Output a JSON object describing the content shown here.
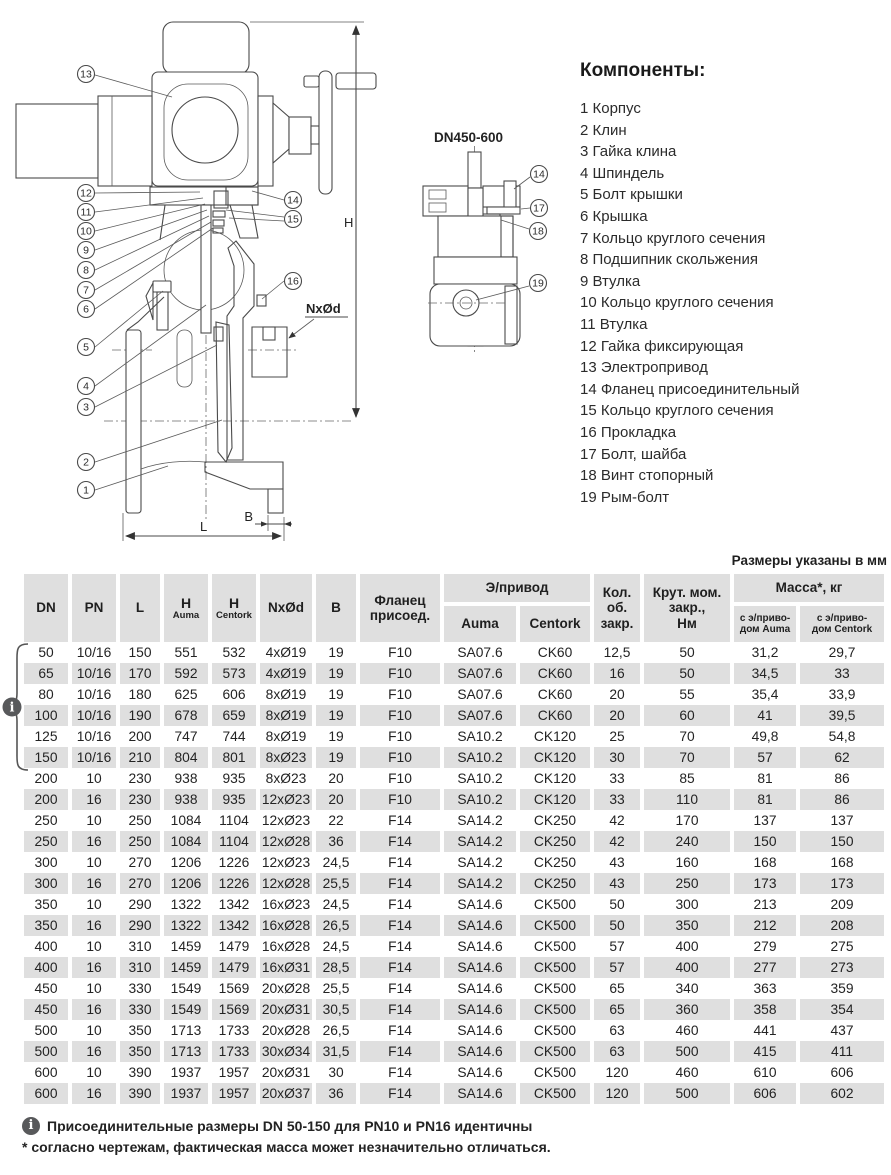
{
  "colors": {
    "table_cell_bg": "#dfdfdf",
    "icon_bg": "#58595b",
    "line": "#4a4a4a"
  },
  "icons": {
    "info": "i"
  },
  "components": {
    "title": "Компоненты:",
    "items": [
      "1 Корпус",
      "2 Клин",
      "3 Гайка клина",
      "4 Шпиндель",
      "5 Болт крышки",
      "6 Крышка",
      "7 Кольцо круглого сечения",
      "8 Подшипник скольжения",
      "9 Втулка",
      "10 Кольцо круглого сечения",
      "11 Втулка",
      "12 Гайка фиксирующая",
      "13 Электропривод",
      "14 Фланец присоединительный",
      "15 Кольцо круглого сечения",
      "16 Прокладка",
      "17 Болт, шайба",
      "18 Винт стопорный",
      "19 Рым-болт"
    ]
  },
  "diagrams": {
    "main": {
      "callouts": [
        "1",
        "2",
        "3",
        "4",
        "5",
        "6",
        "7",
        "8",
        "9",
        "10",
        "11",
        "12",
        "13",
        "14",
        "15",
        "16"
      ],
      "dims": {
        "h": "H",
        "l": "L",
        "b": "B",
        "holes": "NxØd"
      }
    },
    "detail": {
      "title": "DN450-600",
      "callouts": [
        "14",
        "17",
        "18",
        "19"
      ]
    }
  },
  "table": {
    "units_note": "Размеры указаны в мм",
    "header": {
      "dn": "DN",
      "pn": "PN",
      "l": "L",
      "h_label": "H",
      "h_sub_auma": "Auma",
      "h_sub_centork": "Centork",
      "nxod": "NxØd",
      "b": "B",
      "flange": "Фланец\nприсоед.",
      "actuator_group": "Э/привод",
      "auma": "Auma",
      "centork": "Centork",
      "turns": "Кол.\nоб.\nзакр.",
      "torque": "Крут. мом.\nзакр.,\nНм",
      "mass_group": "Масса*, кг",
      "mass_auma": "с э/приво-\nдом Auma",
      "mass_centork": "с э/приво-\nдом Centork"
    },
    "rows": [
      [
        "50",
        "10/16",
        "150",
        "551",
        "532",
        "4xØ19",
        "19",
        "F10",
        "SA07.6",
        "CK60",
        "12,5",
        "50",
        "31,2",
        "29,7"
      ],
      [
        "65",
        "10/16",
        "170",
        "592",
        "573",
        "4xØ19",
        "19",
        "F10",
        "SA07.6",
        "CK60",
        "16",
        "50",
        "34,5",
        "33"
      ],
      [
        "80",
        "10/16",
        "180",
        "625",
        "606",
        "8xØ19",
        "19",
        "F10",
        "SA07.6",
        "CK60",
        "20",
        "55",
        "35,4",
        "33,9"
      ],
      [
        "100",
        "10/16",
        "190",
        "678",
        "659",
        "8xØ19",
        "19",
        "F10",
        "SA07.6",
        "CK60",
        "20",
        "60",
        "41",
        "39,5"
      ],
      [
        "125",
        "10/16",
        "200",
        "747",
        "744",
        "8xØ19",
        "19",
        "F10",
        "SA10.2",
        "CK120",
        "25",
        "70",
        "49,8",
        "54,8"
      ],
      [
        "150",
        "10/16",
        "210",
        "804",
        "801",
        "8xØ23",
        "19",
        "F10",
        "SA10.2",
        "CK120",
        "30",
        "70",
        "57",
        "62"
      ],
      [
        "200",
        "10",
        "230",
        "938",
        "935",
        "8xØ23",
        "20",
        "F10",
        "SA10.2",
        "CK120",
        "33",
        "85",
        "81",
        "86"
      ],
      [
        "200",
        "16",
        "230",
        "938",
        "935",
        "12xØ23",
        "20",
        "F10",
        "SA10.2",
        "CK120",
        "33",
        "110",
        "81",
        "86"
      ],
      [
        "250",
        "10",
        "250",
        "1084",
        "1104",
        "12xØ23",
        "22",
        "F14",
        "SA14.2",
        "CK250",
        "42",
        "170",
        "137",
        "137"
      ],
      [
        "250",
        "16",
        "250",
        "1084",
        "1104",
        "12xØ28",
        "36",
        "F14",
        "SA14.2",
        "CK250",
        "42",
        "240",
        "150",
        "150"
      ],
      [
        "300",
        "10",
        "270",
        "1206",
        "1226",
        "12xØ23",
        "24,5",
        "F14",
        "SA14.2",
        "CK250",
        "43",
        "160",
        "168",
        "168"
      ],
      [
        "300",
        "16",
        "270",
        "1206",
        "1226",
        "12xØ28",
        "25,5",
        "F14",
        "SA14.2",
        "CK250",
        "43",
        "250",
        "173",
        "173"
      ],
      [
        "350",
        "10",
        "290",
        "1322",
        "1342",
        "16xØ23",
        "24,5",
        "F14",
        "SA14.6",
        "CK500",
        "50",
        "300",
        "213",
        "209"
      ],
      [
        "350",
        "16",
        "290",
        "1322",
        "1342",
        "16xØ28",
        "26,5",
        "F14",
        "SA14.6",
        "CK500",
        "50",
        "350",
        "212",
        "208"
      ],
      [
        "400",
        "10",
        "310",
        "1459",
        "1479",
        "16xØ28",
        "24,5",
        "F14",
        "SA14.6",
        "CK500",
        "57",
        "400",
        "279",
        "275"
      ],
      [
        "400",
        "16",
        "310",
        "1459",
        "1479",
        "16xØ31",
        "28,5",
        "F14",
        "SA14.6",
        "CK500",
        "57",
        "400",
        "277",
        "273"
      ],
      [
        "450",
        "10",
        "330",
        "1549",
        "1569",
        "20xØ28",
        "25,5",
        "F14",
        "SA14.6",
        "CK500",
        "65",
        "340",
        "363",
        "359"
      ],
      [
        "450",
        "16",
        "330",
        "1549",
        "1569",
        "20xØ31",
        "30,5",
        "F14",
        "SA14.6",
        "CK500",
        "65",
        "360",
        "358",
        "354"
      ],
      [
        "500",
        "10",
        "350",
        "1713",
        "1733",
        "20xØ28",
        "26,5",
        "F14",
        "SA14.6",
        "CK500",
        "63",
        "460",
        "441",
        "437"
      ],
      [
        "500",
        "16",
        "350",
        "1713",
        "1733",
        "30xØ34",
        "31,5",
        "F14",
        "SA14.6",
        "CK500",
        "63",
        "500",
        "415",
        "411"
      ],
      [
        "600",
        "10",
        "390",
        "1937",
        "1957",
        "20xØ31",
        "30",
        "F14",
        "SA14.6",
        "CK500",
        "120",
        "460",
        "610",
        "606"
      ],
      [
        "600",
        "16",
        "390",
        "1937",
        "1957",
        "20xØ37",
        "36",
        "F14",
        "SA14.6",
        "CK500",
        "120",
        "500",
        "606",
        "602"
      ]
    ]
  },
  "footnotes": {
    "info": "Присоединительные размеры DN 50-150 для PN10 и PN16 идентичны",
    "note": "* согласно чертежам, фактическая масса может незначительно отличаться."
  }
}
